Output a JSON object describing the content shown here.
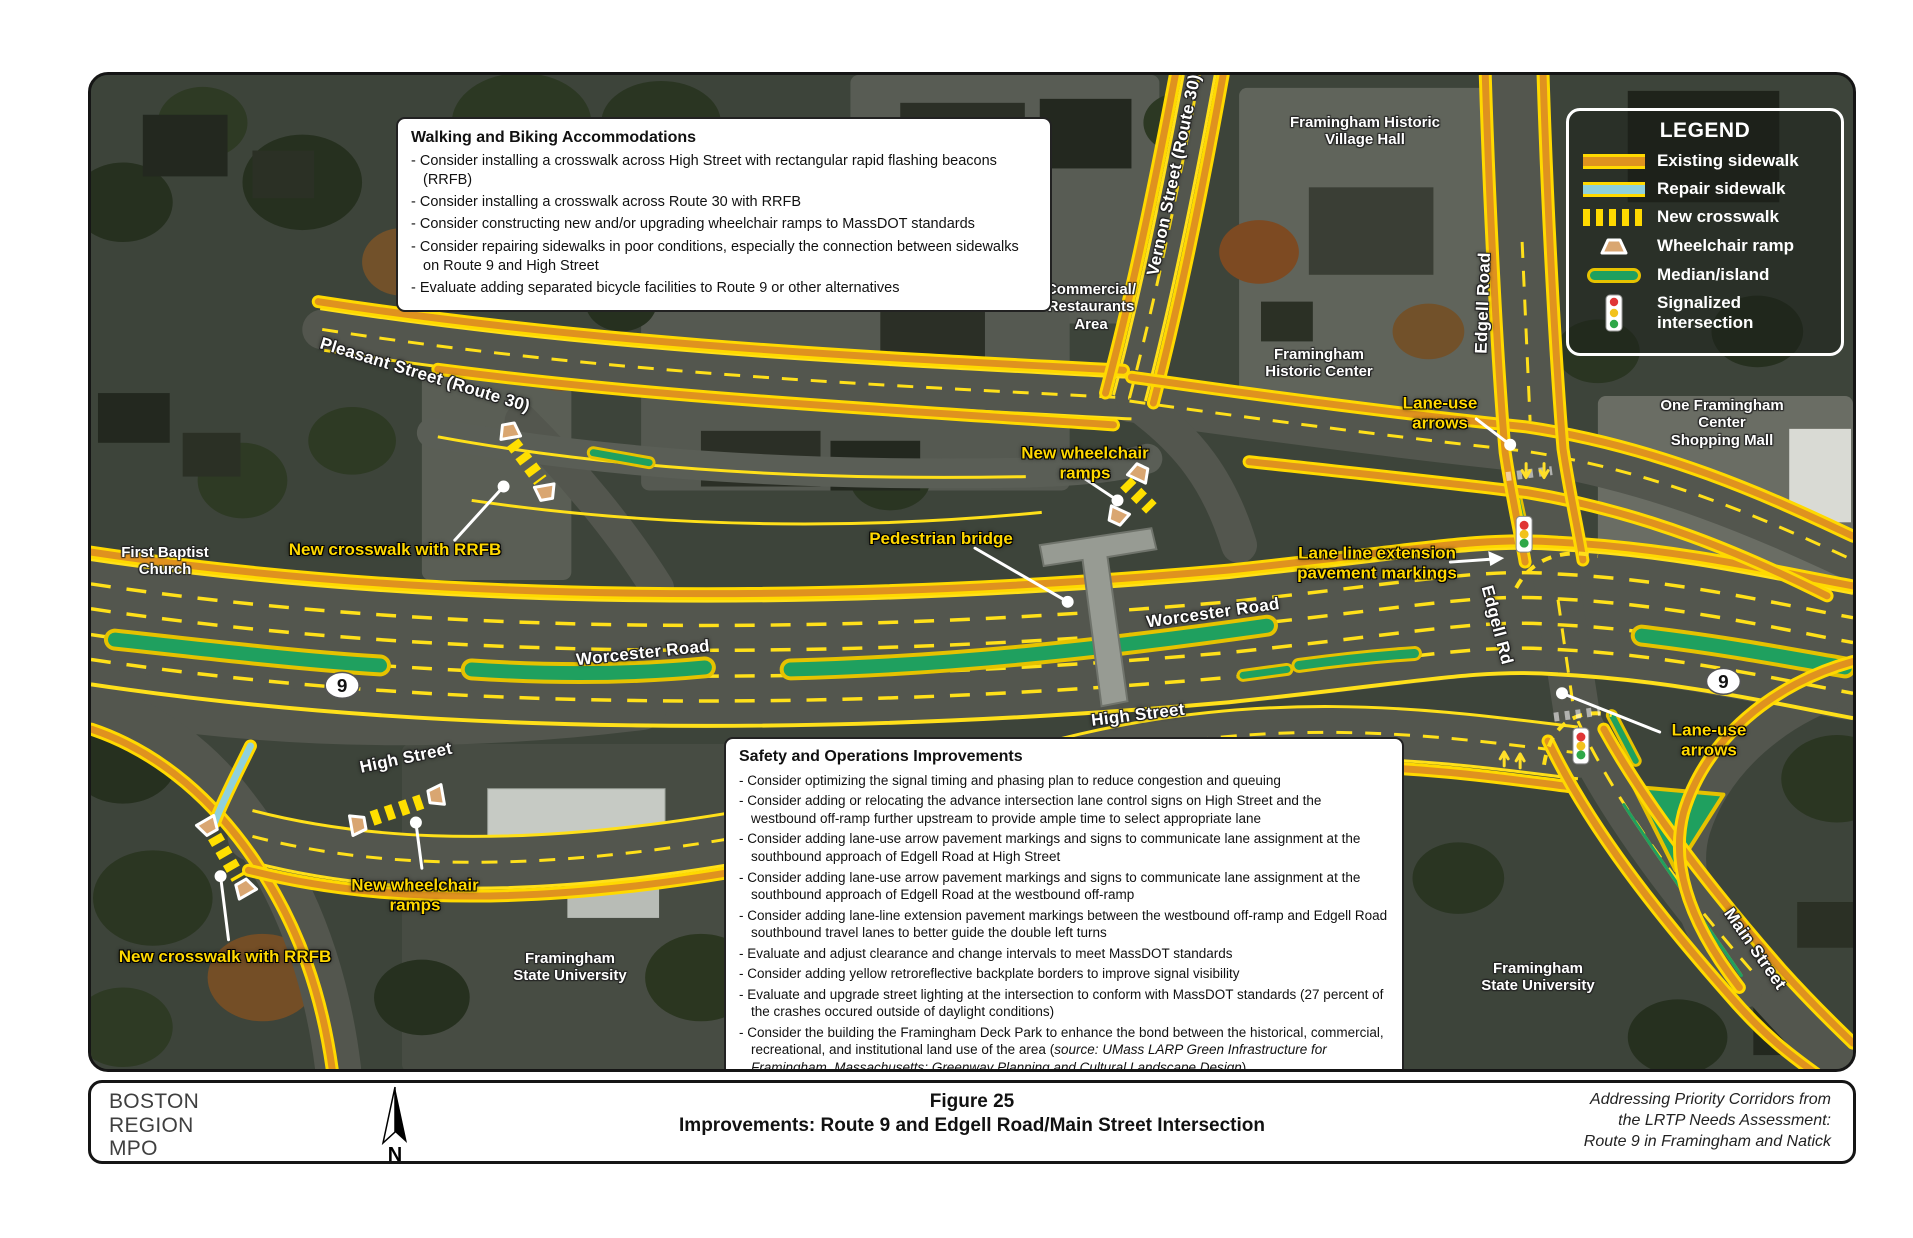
{
  "colors": {
    "sidewalk_yellow": "#ffd900",
    "sidewalk_orange": "#df921f",
    "repair_blue": "#8fd0dc",
    "median_green": "#1fa05f",
    "callout_yellow": "#ffd800",
    "road_gray": "#53564e"
  },
  "map": {
    "legend": {
      "title": "LEGEND",
      "items": [
        {
          "icon": "existing-sidewalk-swatch",
          "label": "Existing sidewalk"
        },
        {
          "icon": "repair-sidewalk-swatch",
          "label": "Repair sidewalk"
        },
        {
          "icon": "new-crosswalk-swatch",
          "label": "New crosswalk"
        },
        {
          "icon": "wheelchair-ramp-icon",
          "label": "Wheelchair ramp"
        },
        {
          "icon": "median-island-swatch",
          "label": "Median/island"
        },
        {
          "icon": "traffic-signal-icon",
          "label": "Signalized intersection"
        }
      ]
    },
    "walking_box": {
      "title": "Walking and Biking Accommodations",
      "items": [
        "Consider installing a crosswalk across High Street with rectangular rapid flashing beacons (RRFB)",
        "Consider installing a crosswalk across Route 30 with RRFB",
        "Consider constructing new and/or upgrading wheelchair ramps to MassDOT standards",
        "Consider repairing sidewalks in poor conditions, especially the connection between sidewalks on Route 9 and High Street",
        "Evaluate adding separated bicycle facilities to Route 9 or other alternatives"
      ]
    },
    "safety_box": {
      "title": "Safety and Operations Improvements",
      "items": [
        {
          "text": "Consider optimizing the signal timing and phasing plan to reduce congestion and queuing",
          "source": "",
          "suffix": ""
        },
        {
          "text": "Consider adding or relocating the advance intersection lane control signs on High Street and the westbound off-ramp further upstream to provide ample time to select appropriate lane",
          "source": "",
          "suffix": ""
        },
        {
          "text": "Consider adding lane-use arrow pavement markings and signs to communicate lane assignment at the southbound approach of Edgell Road at High Street",
          "source": "",
          "suffix": ""
        },
        {
          "text": "Consider adding lane-use arrow pavement markings and signs to communicate lane assignment at the southbound approach of Edgell Road at the westbound off-ramp",
          "source": "",
          "suffix": ""
        },
        {
          "text": "Consider adding lane-line extension pavement markings between the westbound off-ramp and Edgell Road southbound travel lanes to better guide the double left turns",
          "source": "",
          "suffix": ""
        },
        {
          "text": "Evaluate and adjust clearance and change intervals to meet MassDOT standards",
          "source": "",
          "suffix": ""
        },
        {
          "text": "Consider adding yellow retroreflective backplate borders to improve signal visibility",
          "source": "",
          "suffix": ""
        },
        {
          "text": "Evaluate and upgrade street lighting at the intersection to conform with MassDOT standards (27 percent of the crashes occured outside of daylight conditions)",
          "source": "",
          "suffix": ""
        },
        {
          "text": "Consider the building the Framingham Deck Park to enhance the bond between the historical, commercial, recreational, and institutional land use of the area (",
          "source": "source: UMass LARP Green Infrastructure for Framingham, Massachusetts: Greenway Planning and Cultural Landscape Design",
          "suffix": ")"
        }
      ]
    },
    "street_labels": [
      {
        "text": "Pleasant Street (Route 30)"
      },
      {
        "text": "Vernon Street (Route 30)"
      },
      {
        "text": "Edgell Road"
      },
      {
        "text": "Worcester Road"
      },
      {
        "text": "Worcester Road"
      },
      {
        "text": "High Street"
      },
      {
        "text": "High Street"
      },
      {
        "text": "Edgell Rd"
      },
      {
        "text": "Main Street"
      }
    ],
    "place_labels": [
      {
        "text": "First Baptist\nChurch"
      },
      {
        "text": "Framingham Historic\nVillage Hall"
      },
      {
        "text": "Commercial/\nRestaurants\nArea"
      },
      {
        "text": "Framingham\nHistoric Center"
      },
      {
        "text": "One Framingham Center\nShopping Mall"
      },
      {
        "text": "Framingham\nState University"
      },
      {
        "text": "Framingham\nState University"
      }
    ],
    "callouts": [
      {
        "text": "New crosswalk with RRFB"
      },
      {
        "text": "New wheelchair\nramps"
      },
      {
        "text": "Pedestrian bridge"
      },
      {
        "text": "Lane-use\narrows"
      },
      {
        "text": "Lane line extension\npavement markings"
      },
      {
        "text": "Lane-use\narrows"
      },
      {
        "text": "New wheelchair\nramps"
      },
      {
        "text": "New crosswalk with RRFB"
      }
    ],
    "route_shields": [
      {
        "text": "9"
      },
      {
        "text": "9"
      }
    ]
  },
  "footer": {
    "org": "BOSTON\nREGION\nMPO",
    "north_label": "N",
    "figure_no": "Figure 25",
    "figure_title": "Improvements: Route 9 and Edgell Road/Main Street Intersection",
    "source_note": "Addressing Priority Corridors from\nthe LRTP Needs Assessment:\nRoute 9 in Framingham and Natick"
  }
}
